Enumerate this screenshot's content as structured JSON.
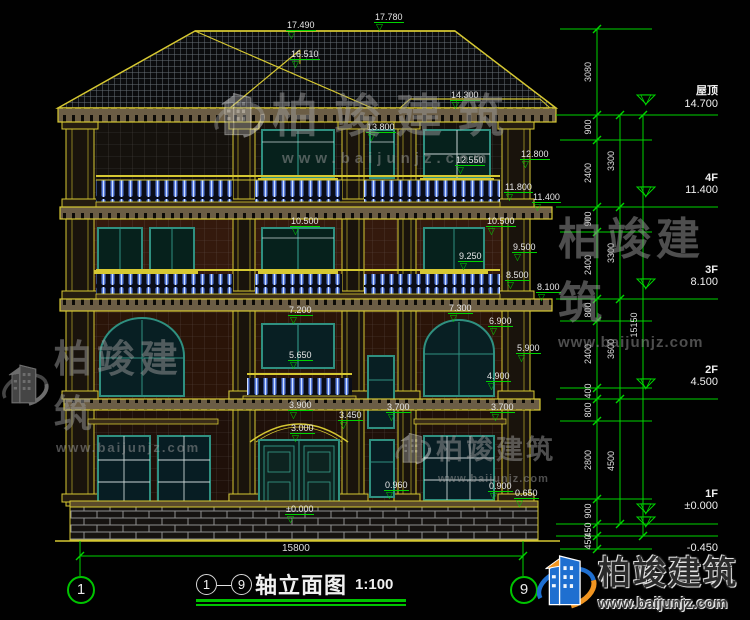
{
  "drawing": {
    "title_axis_from": "1",
    "title_axis_to": "9",
    "title_dash": "—",
    "title_text": "轴立面图",
    "title_scale": "1:100",
    "bottom_dim": "15800",
    "axis_bubble_left": "1",
    "axis_bubble_right": "9"
  },
  "icons": {
    "elev_marker": "▽"
  },
  "watermark": {
    "cn": "柏竣建筑",
    "url": "www.baijunjz.com"
  },
  "colors": {
    "dim_green": "#00d400",
    "cad_yellow": "#d6c832",
    "frame_teal": "#2f9080",
    "baluster_blue": "#5b7fe0",
    "text_white": "#e6e6e6"
  },
  "floor_markers": [
    {
      "label": "屋顶",
      "value": "14.700",
      "x": 648,
      "y": 82,
      "tx": 646,
      "ty": 104
    },
    {
      "label": "4F",
      "value": "11.400",
      "x": 648,
      "y": 172,
      "tx": 646,
      "ty": 196
    },
    {
      "label": "3F",
      "value": "8.100",
      "x": 648,
      "y": 264,
      "tx": 646,
      "ty": 288
    },
    {
      "label": "2F",
      "value": "4.500",
      "x": 648,
      "y": 364,
      "tx": 646,
      "ty": 388
    },
    {
      "label": "1F",
      "value": "±0.000",
      "x": 648,
      "y": 488,
      "tx": 646,
      "ty": 513
    },
    {
      "label": "",
      "value": "-0.450",
      "x": 648,
      "y": 542,
      "tx": 646,
      "ty": 526
    }
  ],
  "elevation_labels": [
    {
      "t": "17.490",
      "x": 286,
      "y": 20
    },
    {
      "t": "17.780",
      "x": 374,
      "y": 12
    },
    {
      "t": "16.510",
      "x": 290,
      "y": 49
    },
    {
      "t": "14.300",
      "x": 450,
      "y": 90
    },
    {
      "t": "13.800",
      "x": 366,
      "y": 122
    },
    {
      "t": "12.800",
      "x": 520,
      "y": 149
    },
    {
      "t": "12.550",
      "x": 455,
      "y": 155
    },
    {
      "t": "11.800",
      "x": 504,
      "y": 182
    },
    {
      "t": "11.400",
      "x": 532,
      "y": 192
    },
    {
      "t": "10.500",
      "x": 290,
      "y": 216
    },
    {
      "t": "10.500",
      "x": 486,
      "y": 216
    },
    {
      "t": "9.500",
      "x": 512,
      "y": 242
    },
    {
      "t": "9.250",
      "x": 458,
      "y": 251
    },
    {
      "t": "8.500",
      "x": 505,
      "y": 270
    },
    {
      "t": "8.100",
      "x": 536,
      "y": 282
    },
    {
      "t": "7.200",
      "x": 288,
      "y": 305
    },
    {
      "t": "7.300",
      "x": 448,
      "y": 303
    },
    {
      "t": "6.900",
      "x": 488,
      "y": 316
    },
    {
      "t": "5.900",
      "x": 516,
      "y": 343
    },
    {
      "t": "5.650",
      "x": 288,
      "y": 350
    },
    {
      "t": "4.900",
      "x": 486,
      "y": 371
    },
    {
      "t": "3.900",
      "x": 288,
      "y": 400
    },
    {
      "t": "3.700",
      "x": 386,
      "y": 402
    },
    {
      "t": "3.700",
      "x": 490,
      "y": 402
    },
    {
      "t": "3.450",
      "x": 338,
      "y": 410
    },
    {
      "t": "3.000",
      "x": 290,
      "y": 423
    },
    {
      "t": "0.960",
      "x": 384,
      "y": 480
    },
    {
      "t": "0.900",
      "x": 488,
      "y": 481
    },
    {
      "t": "0.650",
      "x": 514,
      "y": 488
    },
    {
      "t": "±0.000",
      "x": 285,
      "y": 504
    }
  ],
  "dim_chains": {
    "inner": {
      "x": 588,
      "labels": [
        {
          "t": "3080",
          "y": 72
        },
        {
          "t": "900",
          "y": 127
        },
        {
          "t": "2400",
          "y": 173
        },
        {
          "t": "900",
          "y": 219
        },
        {
          "t": "2400",
          "y": 265
        },
        {
          "t": "800",
          "y": 310
        },
        {
          "t": "2400",
          "y": 354
        },
        {
          "t": "400",
          "y": 391
        },
        {
          "t": "800",
          "y": 410
        },
        {
          "t": "2800",
          "y": 460
        },
        {
          "t": "900",
          "y": 511
        },
        {
          "t": "450",
          "y": 530
        },
        {
          "t": "450",
          "y": 542
        }
      ]
    },
    "mid": {
      "x": 611,
      "labels": [
        {
          "t": "3300",
          "y": 161
        },
        {
          "t": "3300",
          "y": 253
        },
        {
          "t": "3600",
          "y": 349
        },
        {
          "t": "4500",
          "y": 461
        }
      ]
    },
    "outer": {
      "x": 634,
      "labels": [
        {
          "t": "15150",
          "y": 325
        }
      ]
    }
  }
}
